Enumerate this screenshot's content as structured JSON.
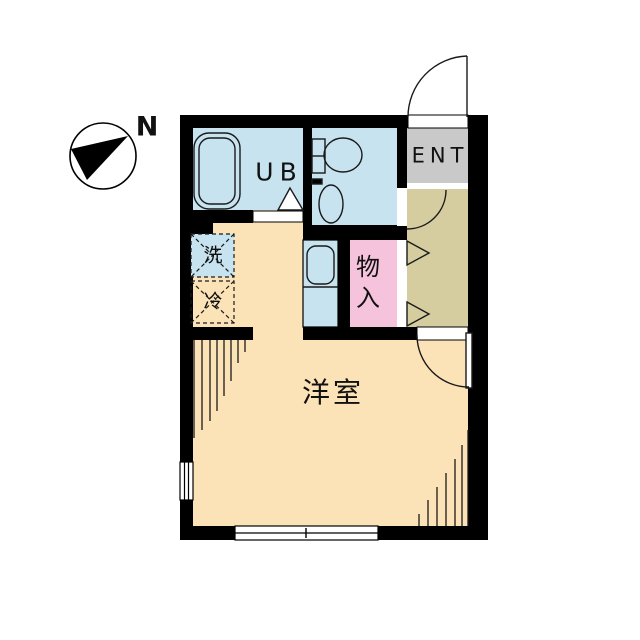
{
  "plan_title": "one-room apartment floor plan",
  "compass": {
    "north_label": "N"
  },
  "rooms": {
    "unit_bath": {
      "label": "UB"
    },
    "entrance": {
      "label": "ENT"
    },
    "storage": {
      "chars": [
        "物",
        "入"
      ]
    },
    "washer_spot": {
      "label": "洗"
    },
    "fridge_spot": {
      "label": "冷"
    },
    "main_room": {
      "label": "洋室"
    }
  },
  "colors": {
    "wall": "#000000",
    "line": "#1a1a1a",
    "wet_area": "#c6e3ef",
    "entrance": "#c9c9c9",
    "hallway": "#d5cda0",
    "storage": "#f6c3dc",
    "room": "#fce3b7",
    "background": "#ffffff"
  }
}
